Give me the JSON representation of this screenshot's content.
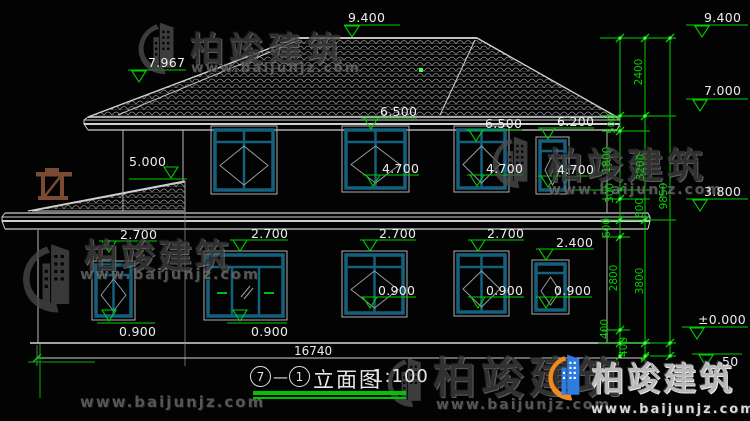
{
  "watermark": {
    "brand": "柏竣建筑",
    "url": "www.baijunjz.com"
  },
  "title": {
    "axis_start": "7",
    "separator": "—",
    "axis_end": "1",
    "name": "立面图",
    "scale": "1:100"
  },
  "colors": {
    "background": "#030303",
    "linework": "#cfcfcf",
    "window_frame_teal": "#14617e",
    "annotation_green": "#00d000",
    "grip_green": "#44ff44",
    "trellis_brown": "#7b4a33",
    "logo_blue": "#2e7ce0",
    "logo_orange": "#ee8a1e"
  },
  "annotations": {
    "total_width_label": "16740",
    "elevation_markers": [
      {
        "label": "9.400",
        "tx": 348,
        "ty": 11,
        "line": [
          344,
          400,
          25
        ],
        "ax": 352,
        "ay": 37
      },
      {
        "label": "9.400",
        "tx": 704,
        "ty": 11,
        "line": [
          686,
          748,
          25
        ],
        "ax": 702,
        "ay": 37
      },
      {
        "label": "7.967",
        "tx": 148,
        "ty": 56,
        "line": [
          128,
          186,
          70
        ],
        "ax": 139,
        "ay": 82
      },
      {
        "label": "5.000",
        "tx": 129,
        "ty": 155,
        "line": [
          129,
          187,
          179
        ],
        "ax": 171,
        "ay": 178
      },
      {
        "label": "6.500",
        "tx": 380,
        "ty": 105,
        "line": [
          361,
          417,
          118
        ],
        "ax": 371,
        "ay": 129
      },
      {
        "label": "6.500",
        "tx": 485,
        "ty": 117,
        "line": [
          466,
          522,
          130
        ],
        "ax": 476,
        "ay": 141
      },
      {
        "label": "6.200",
        "tx": 557,
        "ty": 115,
        "line": [
          538,
          594,
          128
        ],
        "ax": 548,
        "ay": 139
      },
      {
        "label": "4.700",
        "tx": 382,
        "ty": 162,
        "line": [
          363,
          419,
          175
        ],
        "ax": 373,
        "ay": 186
      },
      {
        "label": "4.700",
        "tx": 486,
        "ty": 162,
        "line": [
          467,
          523,
          175
        ],
        "ax": 477,
        "ay": 186
      },
      {
        "label": "4.700",
        "tx": 557,
        "ty": 163,
        "line": [
          538,
          594,
          176
        ],
        "ax": 548,
        "ay": 187
      },
      {
        "label": "2.700",
        "tx": 120,
        "ty": 228,
        "line": [
          99,
          157,
          241
        ],
        "ax": 109,
        "ay": 252
      },
      {
        "label": "2.700",
        "tx": 251,
        "ty": 227,
        "line": [
          230,
          288,
          240
        ],
        "ax": 240,
        "ay": 251
      },
      {
        "label": "2.700",
        "tx": 379,
        "ty": 227,
        "line": [
          360,
          416,
          240
        ],
        "ax": 370,
        "ay": 251
      },
      {
        "label": "2.700",
        "tx": 487,
        "ty": 227,
        "line": [
          468,
          524,
          240
        ],
        "ax": 478,
        "ay": 251
      },
      {
        "label": "2.400",
        "tx": 556,
        "ty": 236,
        "line": [
          536,
          594,
          249
        ],
        "ax": 546,
        "ay": 260
      },
      {
        "label": "0.900",
        "tx": 119,
        "ty": 325,
        "line": [
          97,
          155,
          323
        ],
        "ax": 109,
        "ay": 321
      },
      {
        "label": "0.900",
        "tx": 251,
        "ty": 325,
        "line": [
          227,
          287,
          323
        ],
        "ax": 240,
        "ay": 321
      },
      {
        "label": "0.900",
        "tx": 378,
        "ty": 284,
        "line": [
          360,
          416,
          297
        ],
        "ax": 370,
        "ay": 308
      },
      {
        "label": "0.900",
        "tx": 486,
        "ty": 284,
        "line": [
          468,
          524,
          297
        ],
        "ax": 478,
        "ay": 308
      },
      {
        "label": "0.900",
        "tx": 554,
        "ty": 284,
        "line": [
          536,
          592,
          297
        ],
        "ax": 546,
        "ay": 308
      },
      {
        "label": "7.000",
        "tx": 704,
        "ty": 84,
        "line": [
          686,
          748,
          99
        ],
        "ax": 700,
        "ay": 111
      },
      {
        "label": "3.800",
        "tx": 704,
        "ty": 185,
        "line": [
          686,
          748,
          199
        ],
        "ax": 700,
        "ay": 211
      },
      {
        "label": "±0.000",
        "tx": 698,
        "ty": 313,
        "line": [
          682,
          748,
          327
        ],
        "ax": 697,
        "ay": 339
      },
      {
        "label": "50",
        "tx": 722,
        "ty": 355,
        "line": [
          692,
          742,
          354
        ],
        "ax": 706,
        "ay": 366
      }
    ],
    "chain_dimensions": [
      {
        "label": "2400",
        "x": 639,
        "y": 72
      },
      {
        "label": "500",
        "x": 612,
        "y": 124
      },
      {
        "label": "1800",
        "x": 607,
        "y": 160
      },
      {
        "label": "3200",
        "x": 641,
        "y": 167
      },
      {
        "label": "300",
        "x": 610,
        "y": 193
      },
      {
        "label": "600",
        "x": 640,
        "y": 208
      },
      {
        "label": "600",
        "x": 607,
        "y": 228
      },
      {
        "label": "9850",
        "x": 664,
        "y": 196
      },
      {
        "label": "2800",
        "x": 614,
        "y": 278
      },
      {
        "label": "3800",
        "x": 640,
        "y": 281
      },
      {
        "label": "400",
        "x": 605,
        "y": 329
      },
      {
        "label": "400",
        "x": 624,
        "y": 347
      }
    ]
  }
}
